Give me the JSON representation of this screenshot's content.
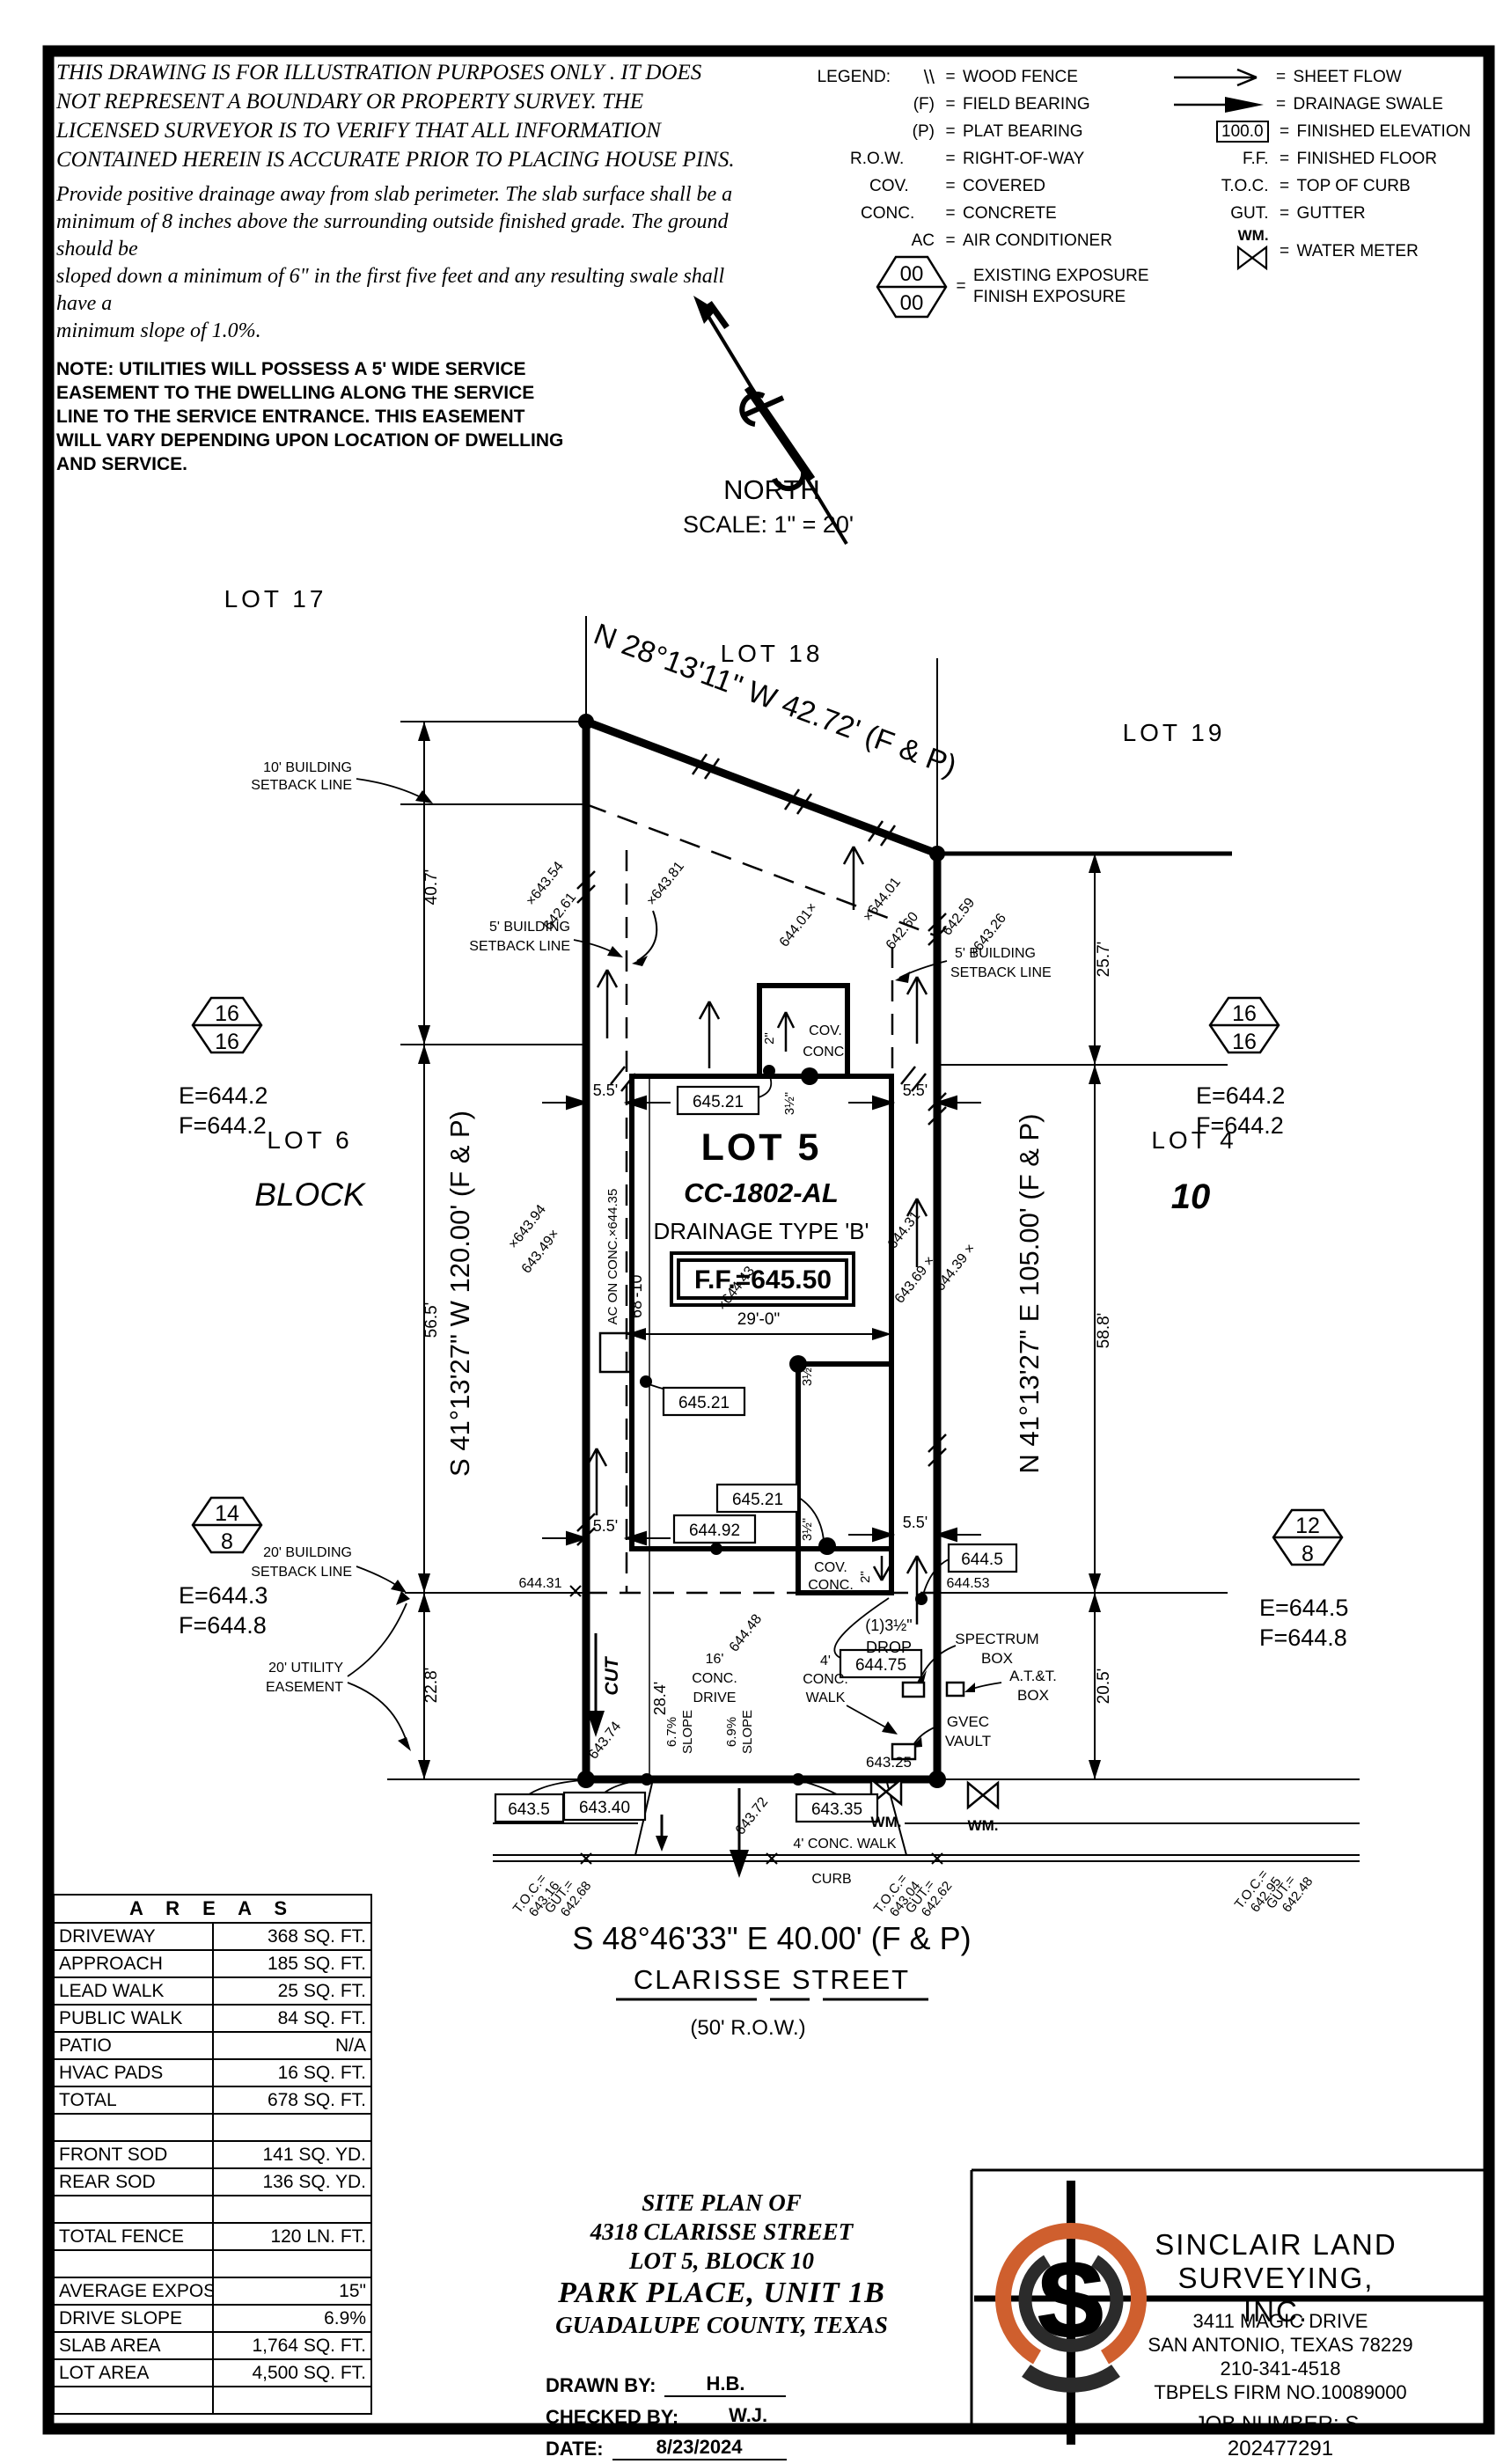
{
  "colors": {
    "ink": "#000000",
    "accent_orange": "#cf5f2e",
    "paper": "#ffffff"
  },
  "disclaimer": {
    "para1": "THIS DRAWING IS FOR ILLUSTRATION PURPOSES ONLY . IT DOES\nNOT REPRESENT A BOUNDARY OR PROPERTY SURVEY. THE\nLICENSED SURVEYOR IS TO VERIFY THAT ALL INFORMATION\nCONTAINED HEREIN IS ACCURATE PRIOR TO PLACING HOUSE PINS.",
    "para2": "Provide positive drainage away from slab perimeter. The slab surface shall be a\nminimum of 8 inches above the surrounding outside finished grade. The ground should be\nsloped down a minimum of 6\" in the first five feet and any resulting swale shall have a\nminimum slope of 1.0%.",
    "note": "NOTE: UTILITIES WILL POSSESS A 5' WIDE SERVICE\nEASEMENT TO THE DWELLING ALONG THE SERVICE\nLINE TO THE SERVICE ENTRANCE. THIS EASEMENT\nWILL VARY DEPENDING UPON LOCATION OF DWELLING\nAND SERVICE."
  },
  "legend": {
    "title": "LEGEND:",
    "left": [
      {
        "sym": "\\\\",
        "label": "WOOD FENCE"
      },
      {
        "sym": "(F)",
        "label": "FIELD BEARING"
      },
      {
        "sym": "(P)",
        "label": "PLAT BEARING"
      },
      {
        "sym": "R.O.W.",
        "label": "RIGHT-OF-WAY"
      },
      {
        "sym": "COV.",
        "label": "COVERED"
      },
      {
        "sym": "CONC.",
        "label": "CONCRETE"
      },
      {
        "sym": "AC",
        "label": "AIR CONDITIONER"
      }
    ],
    "exposure": {
      "top": "00",
      "bottom": "00",
      "line1": "EXISTING EXPOSURE",
      "line2": "FINISH EXPOSURE"
    },
    "right": [
      {
        "sym": "",
        "label": "SHEET FLOW"
      },
      {
        "sym": "",
        "label": "DRAINAGE SWALE"
      },
      {
        "sym": "100.0",
        "label": "FINISHED ELEVATION"
      },
      {
        "sym": "F.F.",
        "label": "FINISHED FLOOR"
      },
      {
        "sym": "T.O.C.",
        "label": "TOP OF CURB"
      },
      {
        "sym": "GUT.",
        "label": "GUTTER"
      },
      {
        "sym": "WM.",
        "label": "WATER METER"
      }
    ]
  },
  "north": {
    "label": "NORTH",
    "scale": "SCALE: 1\" = 20'"
  },
  "plan": {
    "lots": {
      "lot17": "LOT 17",
      "lot18": "LOT 18",
      "lot19": "LOT 19",
      "lot6": "LOT 6",
      "lot4": "LOT 4",
      "lot5": "LOT 5",
      "block_word": "BLOCK",
      "block_num": "10"
    },
    "bearings": {
      "rear": "N 28°13'11\" W 42.72' (F & P)",
      "left": "S 41°13'27\" W 120.00' (F & P)",
      "right": "N 41°13'27\" E 105.00' (F & P)",
      "front": "S 48°46'33\" E 40.00' (F & P)"
    },
    "street": {
      "name": "CLARISSE STREET",
      "row": "(50' R.O.W.)",
      "walk": "4' CONC. WALK",
      "curb": "CURB"
    },
    "house": {
      "cc": "CC-1802-AL",
      "drainage": "DRAINAGE TYPE 'B'",
      "ff": "F.F.=645.50",
      "cov1": "COV.",
      "conc1": "CONC.",
      "cov2": "COV.",
      "conc2": "CONC.",
      "two_a": "2\"",
      "two_b": "2\"",
      "drop1": "(1)3½\"",
      "drop2": "DROP",
      "half1": "3½\"",
      "half2": "3½\"",
      "half3": "3½\"",
      "ac_line": "AC ON CONC.×644.35"
    },
    "dims": {
      "d1": "40.7'",
      "d2": "56.5'",
      "d3": "22.8'",
      "d4": "25.7'",
      "d5": "58.8'",
      "d6": "20.5'",
      "d7": "29'-0\"",
      "d8": "68'-10\"",
      "d9": "28.4'",
      "s55a": "5.5'",
      "s55b": "5.5'",
      "s55c": "5.5'",
      "s55d": "5.5'"
    },
    "setbacks": {
      "s10a": "10' BUILDING",
      "s10b": "SETBACK LINE",
      "s5la": "5' BUILDING",
      "s5lb": "SETBACK LINE",
      "s5ra": "5' BUILDING",
      "s5rb": "SETBACK LINE",
      "s20a": "20' BUILDING",
      "s20b": "SETBACK LINE",
      "uea": "20' UTILITY",
      "ueb": "EASEMENT"
    },
    "drive": {
      "cut": "CUT",
      "l16a": "16'",
      "l16b": "CONC.",
      "l16c": "DRIVE",
      "sl67a": "6.7%",
      "sl67b": "SLOPE",
      "sl69a": "6.9%",
      "sl69b": "SLOPE",
      "walk4a": "4'",
      "walk4b": "CONC.",
      "walk4c": "WALK"
    },
    "util": {
      "spectrum1": "SPECTRUM",
      "spectrum2": "BOX",
      "att1": "A.T.&T.",
      "att2": "BOX",
      "gvec1": "GVEC",
      "gvec2": "VAULT",
      "wm1": "WM.",
      "wm2": "WM.",
      "e64325": "643.25"
    },
    "boxes": {
      "v1": "645.21",
      "v2": "645.21",
      "v3": "645.21",
      "v4": "644.92",
      "v5": "644.5",
      "v6": "644.75",
      "v7": "643.5",
      "v8": "643.40",
      "v9": "643.35"
    },
    "elev": {
      "a1": "×643.54",
      "a2": "642.61",
      "a3": "×643.81",
      "a4": "644.01×",
      "a5": "×644.01",
      "a6": "642.60",
      "a7": "642.59",
      "a8": "×643.26",
      "b1": "×643.94",
      "b2": "643.49×",
      "b3": "×644.43",
      "c1": "644.31",
      "c2": "643.69 ×",
      "c3": "644.39 ×",
      "d1": "644.31",
      "d2": "644.53",
      "cut_e": "643.74",
      "drv_e": "644.48",
      "st_e": "643.72"
    },
    "toc": {
      "g1a": "T.O.C.=",
      "g1b": "643.16",
      "g1c": "GUT.=",
      "g1d": "642.68",
      "g2a": "T.O.C.=",
      "g2b": "643.04",
      "g2c": "GUT.=",
      "g2d": "642.62",
      "g3a": "T.O.C.=",
      "g3b": "642.95",
      "g3c": "GUT.=",
      "g3d": "642.48"
    },
    "exposure": {
      "h1t": "16",
      "h1b": "16",
      "h1e": "E=644.2",
      "h1f": "F=644.2",
      "h2t": "16",
      "h2b": "16",
      "h2e": "E=644.2",
      "h2f": "F=644.2",
      "h3t": "14",
      "h3b": "8",
      "h3e": "E=644.3",
      "h3f": "F=644.8",
      "h4t": "12",
      "h4b": "8",
      "h4e": "E=644.5",
      "h4f": "F=644.8"
    }
  },
  "areas": {
    "title": "A R E A S",
    "rows": [
      [
        "DRIVEWAY",
        "368 SQ. FT."
      ],
      [
        "APPROACH",
        "185 SQ. FT."
      ],
      [
        "LEAD WALK",
        "25 SQ. FT."
      ],
      [
        "PUBLIC WALK",
        "84 SQ. FT."
      ],
      [
        "PATIO",
        "N/A"
      ],
      [
        "HVAC PADS",
        "16 SQ. FT."
      ],
      [
        "TOTAL",
        "678 SQ. FT."
      ],
      [
        "",
        ""
      ],
      [
        "FRONT SOD",
        "141 SQ. YD."
      ],
      [
        "REAR SOD",
        "136 SQ. YD."
      ],
      [
        "",
        ""
      ],
      [
        "TOTAL FENCE",
        "120 LN. FT."
      ],
      [
        "",
        ""
      ],
      [
        "AVERAGE EXPOSURE",
        "15\""
      ],
      [
        "DRIVE SLOPE",
        "6.9%"
      ],
      [
        "SLAB AREA",
        "1,764 SQ. FT."
      ],
      [
        "LOT AREA",
        "4,500 SQ. FT."
      ],
      [
        "",
        ""
      ]
    ]
  },
  "title_block": {
    "line1": "SITE PLAN OF",
    "line2": "4318 CLARISSE STREET",
    "line3": "LOT 5, BLOCK 10",
    "line4": "PARK PLACE, UNIT 1B",
    "line5": "GUADALUPE COUNTY, TEXAS",
    "drawn_label": "DRAWN BY:",
    "drawn": "H.B.",
    "checked_label": "CHECKED BY:",
    "checked": "W.J.",
    "date_label": "DATE:",
    "date": "8/23/2024"
  },
  "firm": {
    "name1": "SINCLAIR LAND",
    "name2": "SURVEYING, INC.",
    "address1": "3411 MAGIC DRIVE",
    "address2": "SAN ANTONIO, TEXAS 78229",
    "phone": "210-341-4518",
    "license": "TBPELS FIRM NO.10089000",
    "job_label": "JOB NUMBER:",
    "job": "S-202477291",
    "logo_letter": "S"
  }
}
